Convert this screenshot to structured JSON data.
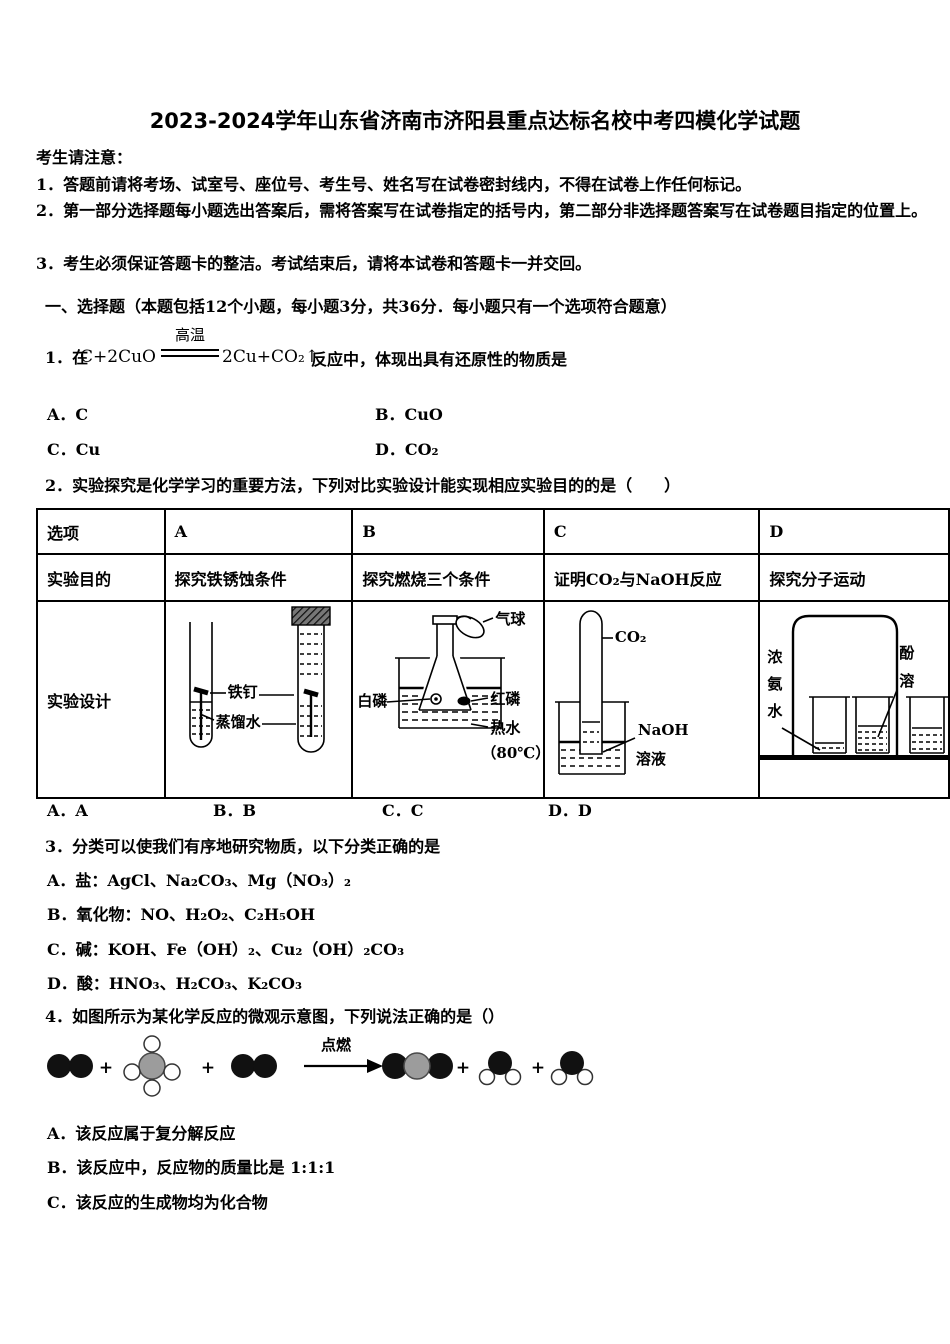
{
  "title": "2023-2024学年山东省济南市济阳县重点达标名校中考四模化学试题",
  "notice": {
    "heading": "考生请注意：",
    "line1": "1．答题前请将考场、试室号、座位号、考生号、姓名写在试卷密封线内，不得在试卷上作任何标记。",
    "line2": "2．第一部分选择题每小题选出答案后，需将答案写在试卷指定的括号内，第二部分非选择题答案写在试卷题目指定的位置上。",
    "line3": "3．考生必须保证答题卡的整洁。考试结束后，请将本试卷和答题卡一并交回。"
  },
  "section": {
    "heading": "一、选择题（本题包括12个小题，每小题3分，共36分．每小题只有一个选项符合题意）"
  },
  "q1": {
    "prefix": "1．在",
    "eq_lhs": "C+2CuO",
    "eq_condition": "高温",
    "eq_rhs": "2Cu+CO₂↑",
    "suffix": "反应中，体现出具有还原性的物质是",
    "opt_a": "A．C",
    "opt_b": "B．CuO",
    "opt_c": "C．Cu",
    "opt_d": "D．CO₂"
  },
  "q2": {
    "text": "2．实验探究是化学学习的重要方法，下列对比实验设计能实现相应实验目的的是（　　）",
    "table": {
      "col0": "选项",
      "col1": "A",
      "col2": "B",
      "col3": "C",
      "col4": "D",
      "row2_label": "实验目的",
      "purpose_a": "探究铁锈蚀条件",
      "purpose_b": "探究燃烧三个条件",
      "purpose_c": "证明CO₂与NaOH反应",
      "purpose_d": "探究分子运动",
      "row3_label": "实验设计"
    },
    "diagram_a": {
      "nail": "铁钉",
      "water": "蒸馏水"
    },
    "diagram_b": {
      "balloon": "气球",
      "white_phosphorus": "白磷",
      "red_phosphorus": "红磷",
      "hot_water": "热水",
      "temperature": "（80℃）"
    },
    "diagram_c": {
      "gas": "CO₂",
      "naoh": "NaOH",
      "solution": "溶液"
    },
    "diagram_d": {
      "ammonia": "浓氨水",
      "partial_top": "酚",
      "partial_bottom": "溶"
    },
    "answers": {
      "a": "A．A",
      "b": "B．B",
      "c": "C．C",
      "d": "D．D"
    }
  },
  "q3": {
    "text": "3．分类可以使我们有序地研究物质，以下分类正确的是",
    "opt_a": "A．盐：AgCl、Na₂CO₃、Mg（NO₃）₂",
    "opt_b": "B．氧化物：NO、H₂O₂、C₂H₅OH",
    "opt_c": "C．碱：KOH、Fe（OH）₂、Cu₂（OH）₂CO₃",
    "opt_d": "D．酸：HNO₃、H₂CO₃、K₂CO₃"
  },
  "q4": {
    "text": "4．如图所示为某化学反应的微观示意图，下列说法正确的是（）",
    "ignite": "点燃",
    "plus": "+",
    "opt_a": "A．该反应属于复分解反应",
    "opt_b": "B．该反应中，反应物的质量比是 1:1:1",
    "opt_c": "C．该反应的生成物均为化合物"
  },
  "colors": {
    "ink": "#000000",
    "molecule_black": "#111111",
    "molecule_gray": "#9c9c9c"
  }
}
